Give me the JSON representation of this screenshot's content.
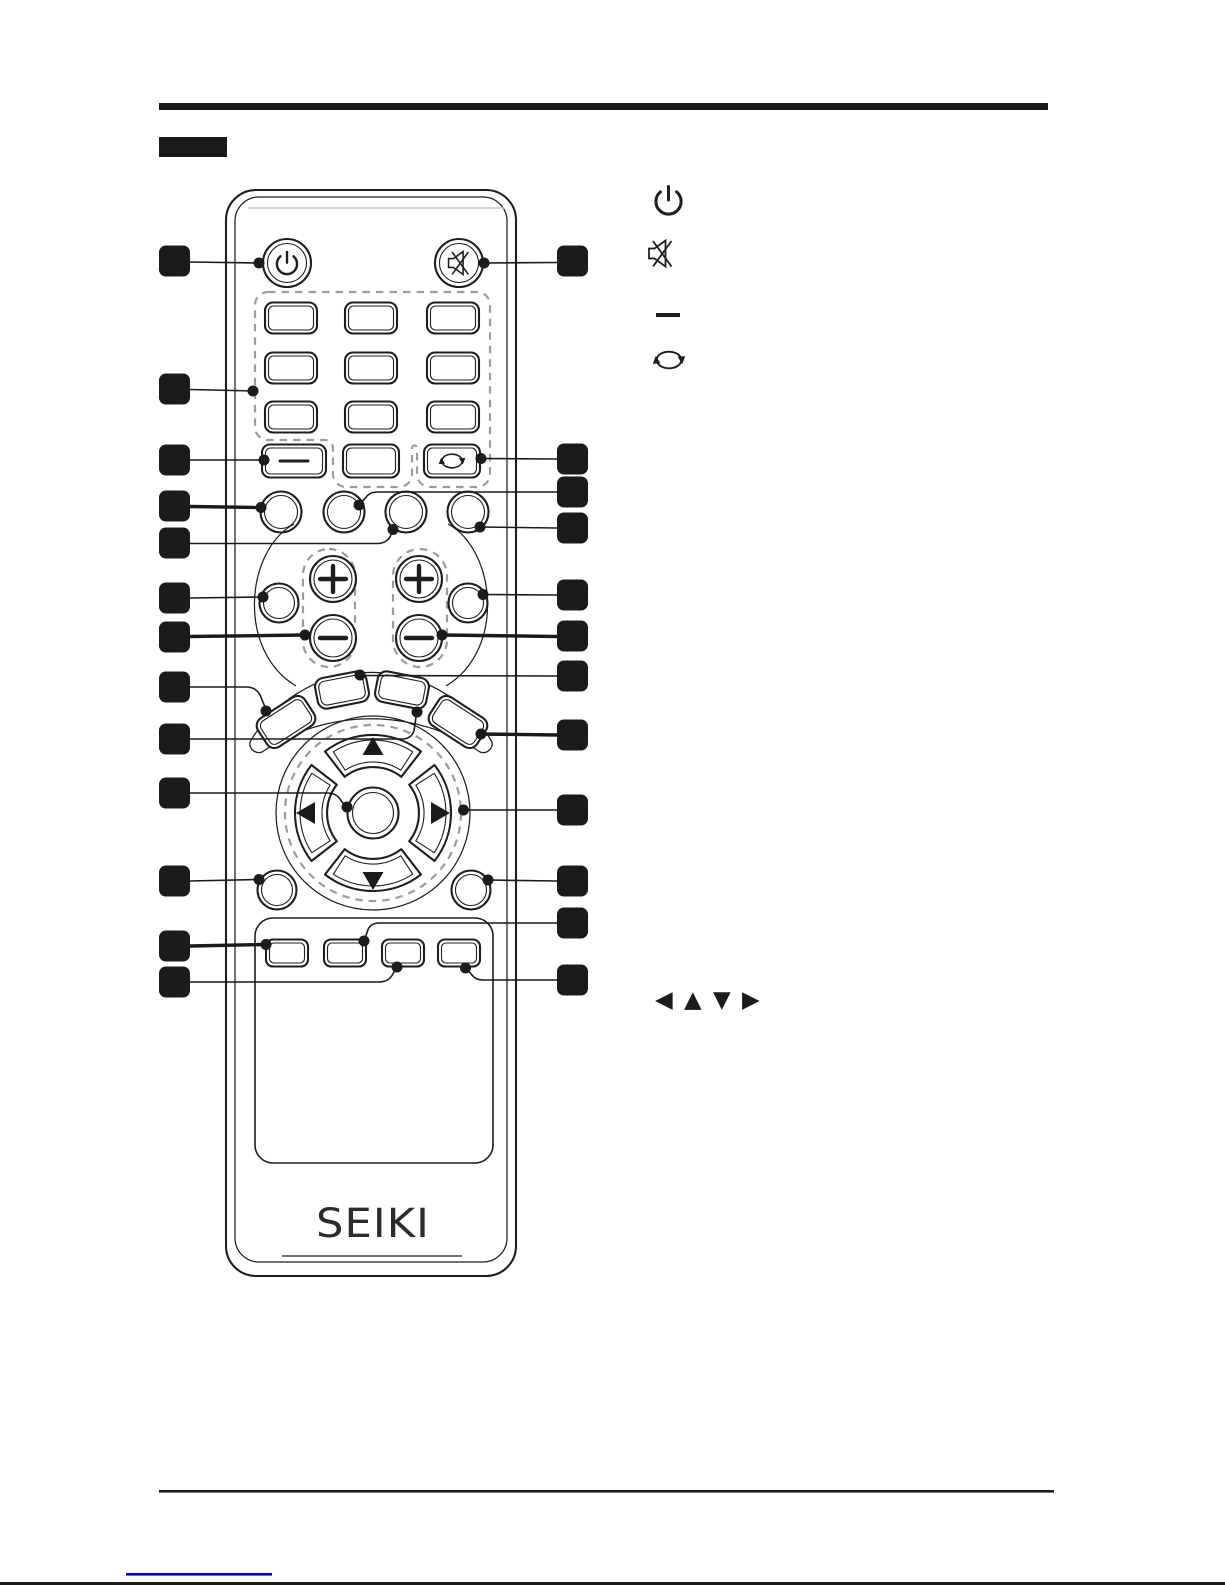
{
  "page": {
    "background": "#ffffff",
    "ink_color": "#1e1e1e",
    "dashed_color": "#9c9c9c",
    "link_color": "#0000cc"
  },
  "header": {
    "section_label_text": ""
  },
  "remote": {
    "brand": "SEIKI",
    "button_groups": {
      "top": [
        "power-button",
        "mute-button"
      ],
      "numpad_key_count": 9,
      "below_numpad": [
        "dash-key",
        "blank-key",
        "rotate-key"
      ],
      "round_key_count": 4,
      "rockers": [
        "plus",
        "minus"
      ],
      "dpad": [
        "up",
        "left",
        "ok",
        "right",
        "down"
      ],
      "bottom_small_key_count": 4
    }
  },
  "legend": {
    "icons": [
      "power-icon",
      "mute-icon",
      "dash-icon",
      "rotate-icon"
    ],
    "nav_arrows": "◀ ▲ ▼ ▶"
  },
  "callouts": {
    "left_count": 13,
    "right_count": 12,
    "label_text": ""
  }
}
